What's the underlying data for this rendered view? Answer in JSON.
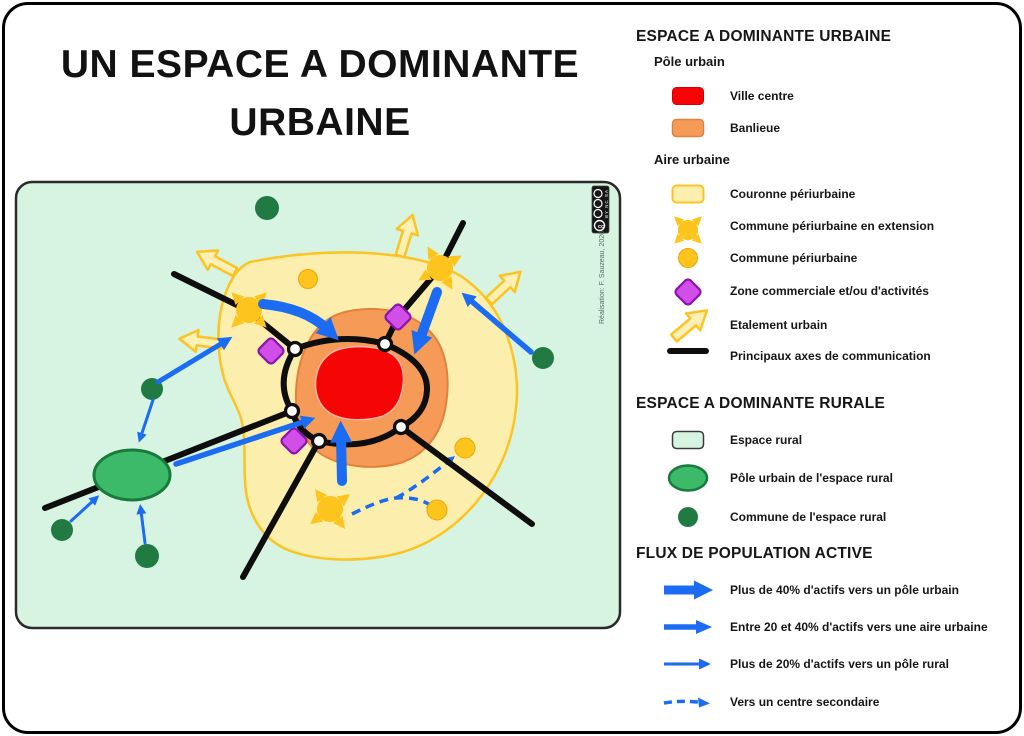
{
  "page": {
    "title_line1": "UN ESPACE A DOMINANTE",
    "title_line2": "URBAINE"
  },
  "map": {
    "attribution": "Réalisation: F. Sauzeau, 2026",
    "cc_license": "BY NC SA"
  },
  "legend": {
    "urban": {
      "title": "ESPACE A DOMINANTE URBAINE",
      "pole_urbain_label": "Pôle urbain",
      "ville_centre": "Ville centre",
      "banlieue": "Banlieue",
      "aire_urbaine_label": "Aire urbaine",
      "couronne": "Couronne périurbaine",
      "commune_extension": "Commune périurbaine en extension",
      "commune_periurbaine": "Commune périurbaine",
      "zone_commerciale": "Zone commerciale et/ou d'activités",
      "etalement": "Etalement urbain",
      "axes": "Principaux axes de communication"
    },
    "rural": {
      "title": "ESPACE A DOMINANTE RURALE",
      "espace_rural": "Espace rural",
      "pole_urbain_rural": "Pôle urbain de l'espace rural",
      "commune_rurale": "Commune de l'espace rural"
    },
    "flux": {
      "title": "FLUX DE POPULATION ACTIVE",
      "flux_40": "Plus de 40% d'actifs vers un pôle urbain",
      "flux_20_40": "Entre 20 et 40% d'actifs vers une aire urbaine",
      "flux_20": "Plus de 20% d'actifs vers un pôle rural",
      "flux_secondaire": "Vers un centre secondaire"
    }
  },
  "colors": {
    "ville_centre": "#f60505",
    "banlieue": "#f59b57",
    "couronne": "#fcefae",
    "couronne_border": "#fbc324",
    "commune_jaune": "#fcc41c",
    "zone_commerciale": "#d14fe8",
    "espace_rural": "#d7f4e2",
    "pole_rural": "#3cba69",
    "commune_rurale": "#217a42",
    "flux_bleu": "#1b6cf2",
    "axes_noir": "#0e0e0e"
  }
}
